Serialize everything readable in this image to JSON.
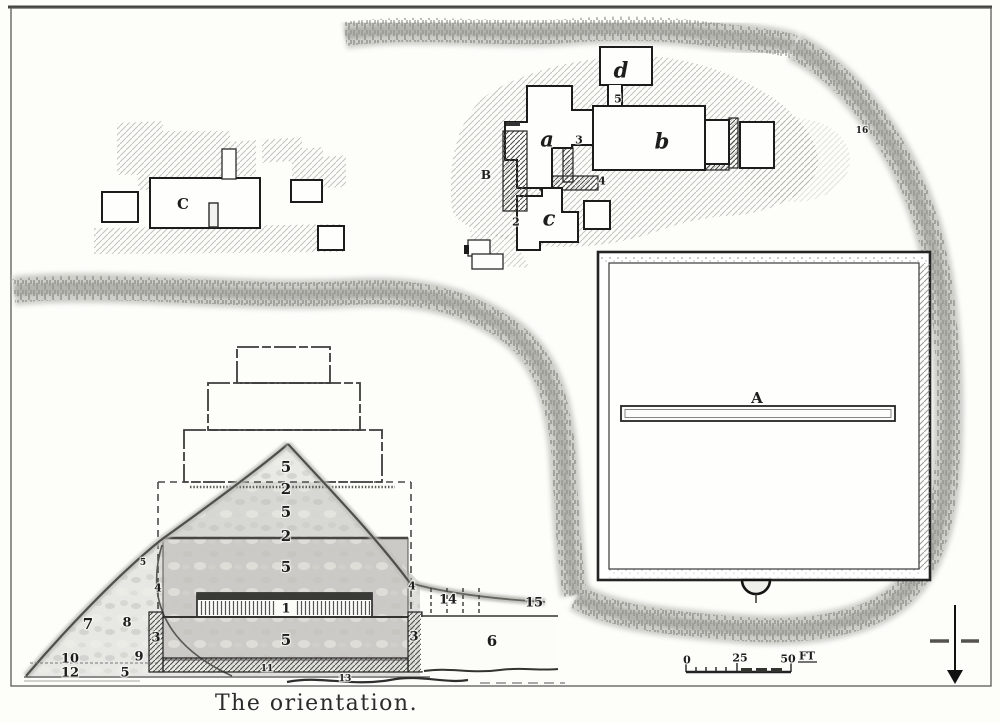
{
  "figure": {
    "caption": "The orientation."
  },
  "scale_bar": {
    "zero": "0",
    "mid": "25",
    "end": "50",
    "unit": "FT"
  },
  "compass": {
    "direction": "south-pointing-arrow"
  },
  "plan_labels": [
    {
      "text": "C",
      "x": 183,
      "y": 204,
      "kind": "letter"
    },
    {
      "text": "A",
      "x": 757,
      "y": 398,
      "kind": "letter"
    },
    {
      "text": "B",
      "x": 486,
      "y": 175,
      "kind": "letter-sm"
    },
    {
      "text": "a",
      "x": 547,
      "y": 139,
      "kind": "letter-italic"
    },
    {
      "text": "b",
      "x": 662,
      "y": 141,
      "kind": "letter-italic"
    },
    {
      "text": "c",
      "x": 549,
      "y": 218,
      "kind": "letter-italic"
    },
    {
      "text": "d",
      "x": 621,
      "y": 70,
      "kind": "letter-italic"
    },
    {
      "text": "5",
      "x": 618,
      "y": 99,
      "kind": "num-sm"
    },
    {
      "text": "3",
      "x": 579,
      "y": 140,
      "kind": "num-sm"
    },
    {
      "text": "4",
      "x": 602,
      "y": 181,
      "kind": "num-sm"
    },
    {
      "text": "2",
      "x": 516,
      "y": 222,
      "kind": "num-sm"
    },
    {
      "text": "5",
      "x": 286,
      "y": 467,
      "kind": "num-lg"
    },
    {
      "text": "2",
      "x": 286,
      "y": 489,
      "kind": "num-lg"
    },
    {
      "text": "5",
      "x": 286,
      "y": 512,
      "kind": "num-lg"
    },
    {
      "text": "2",
      "x": 286,
      "y": 536,
      "kind": "num-lg"
    },
    {
      "text": "5",
      "x": 286,
      "y": 567,
      "kind": "num-lg"
    },
    {
      "text": "1",
      "x": 286,
      "y": 609,
      "kind": "num"
    },
    {
      "text": "5",
      "x": 286,
      "y": 640,
      "kind": "num-lg"
    },
    {
      "text": "4",
      "x": 158,
      "y": 588,
      "kind": "num-sm"
    },
    {
      "text": "4",
      "x": 412,
      "y": 586,
      "kind": "num-sm"
    },
    {
      "text": "3",
      "x": 156,
      "y": 638,
      "kind": "num"
    },
    {
      "text": "3",
      "x": 414,
      "y": 637,
      "kind": "num"
    },
    {
      "text": "7",
      "x": 88,
      "y": 624,
      "kind": "num-lg"
    },
    {
      "text": "8",
      "x": 127,
      "y": 623,
      "kind": "num"
    },
    {
      "text": "9",
      "x": 139,
      "y": 657,
      "kind": "num"
    },
    {
      "text": "10",
      "x": 70,
      "y": 659,
      "kind": "num"
    },
    {
      "text": "12",
      "x": 70,
      "y": 673,
      "kind": "num"
    },
    {
      "text": "5",
      "x": 125,
      "y": 673,
      "kind": "num"
    },
    {
      "text": "5",
      "x": 143,
      "y": 563,
      "kind": "num-xs"
    },
    {
      "text": "14",
      "x": 448,
      "y": 600,
      "kind": "num"
    },
    {
      "text": "15",
      "x": 534,
      "y": 603,
      "kind": "num"
    },
    {
      "text": "6",
      "x": 492,
      "y": 641,
      "kind": "num-lg"
    },
    {
      "text": "11",
      "x": 267,
      "y": 669,
      "kind": "num-xs"
    },
    {
      "text": "13",
      "x": 345,
      "y": 679,
      "kind": "num-xs"
    },
    {
      "text": "16",
      "x": 862,
      "y": 131,
      "kind": "num-xs"
    }
  ]
}
